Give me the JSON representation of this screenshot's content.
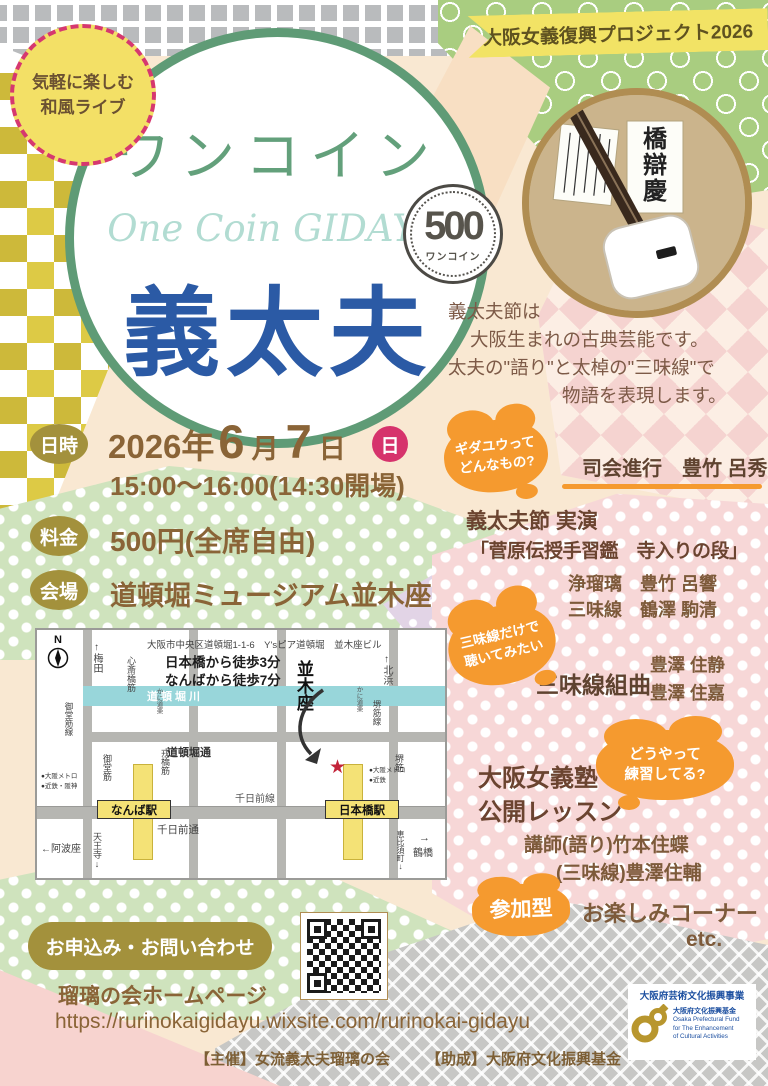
{
  "banner": {
    "text": "大阪女義復興プロジェクト2026"
  },
  "badge": {
    "line1": "気軽に楽しむ",
    "line2": "和風ライブ"
  },
  "title": {
    "katakana": "ワンコイン",
    "english": "One Coin GIDAYU",
    "kanji": "義太夫"
  },
  "coin": {
    "value": "500",
    "label": "ワンコイン"
  },
  "intro": {
    "line1": "義太夫節は",
    "line2": "大阪生まれの古典芸能です。",
    "line3": "太夫の\"語り\"と太棹の\"三味線\"で",
    "line4": "物語を表現します。"
  },
  "info": {
    "datetime_label": "日時",
    "year": "2026年",
    "month": "6",
    "month_unit": "月",
    "day": "7",
    "day_unit": "日",
    "weekday": "日",
    "time": "15:00〜16:00(14:30開場)",
    "fee_label": "料金",
    "fee": "500円(全席自由)",
    "venue_label": "会場",
    "venue": "道頓堀ミュージアム並木座"
  },
  "program": {
    "bubble1_l1": "ギダユウって",
    "bubble1_l2": "どんなもの?",
    "mc": "司会進行　豊竹 呂秀",
    "perf_title": "義太夫節 実演",
    "perf_piece": "「菅原伝授手習鑑　寺入りの段」",
    "joruri": "浄瑠璃　豊竹 呂響",
    "shamisen": "三味線　鶴澤 駒清",
    "bubble2_l1": "三味線だけで",
    "bubble2_l2": "聴いてみたい",
    "suite_title": "三味線組曲",
    "suite_name1": "豊澤 住静",
    "suite_name2": "豊澤 住嘉",
    "bubble3_l1": "どうやって",
    "bubble3_l2": "練習してる?",
    "lesson_l1": "大阪女義塾",
    "lesson_l2": "公開レッスン",
    "teacher1": "講師(語り)竹本住蝶",
    "teacher2": "(三味線)豊澤住輔",
    "participation": "参加型",
    "fun": "お楽しみコーナー",
    "etc": "etc."
  },
  "map": {
    "address": "大阪市中央区道頓堀1-1-6　Y'sピア道頓堀　並木座ビル",
    "walk1": "日本橋から徒歩3分",
    "walk2": "なんばから徒歩7分",
    "compass": "N",
    "umeda": "↑梅田",
    "kitahama": "↑北浜",
    "midosuji_line": "御堂筋線",
    "shinsaibashi": "心斎橋筋",
    "midosuji": "御堂筋",
    "ebisubashi": "戎橋筋",
    "sakaisuji_line": "堺筋線",
    "sakaisuji": "堺筋",
    "kani_west": "かに道楽",
    "kani_east": "かに道楽",
    "river": "道頓堀川",
    "dotonbori_dori": "道頓堀通",
    "sennichimae_line": "千日前線",
    "sennichimae_dori": "千日前通",
    "namba": "なんば駅",
    "namba_note1": "●大阪メトロ",
    "namba_note2": "●近鉄・阪神",
    "nihonbashi": "日本橋駅",
    "nihonbashi_note1": "●大阪メトロ",
    "nihonbashi_note2": "●近鉄",
    "awaza": "←阿波座",
    "tennoji": "天王寺↓",
    "tsuruhashi_arrow": "→",
    "tsuruhashi": "鶴橋",
    "ebisucho": "恵比須町↓",
    "namikiza": "並木座",
    "star": "★"
  },
  "contact": {
    "heading": "お申込み・お問い合わせ",
    "homepage": "瑠璃の会ホームページ",
    "url": "https://rurinokaigidayu.wixsite.com/rurinokai-gidayu"
  },
  "footer": {
    "organizer": "【主催】女流義太夫瑠璃の会",
    "grant": "【助成】大阪府文化振興基金",
    "logo_title": "大阪府芸術文化振興事業",
    "logo_jp": "大阪府文化振興基金",
    "logo_en1": "Osaka Prefectural Fund",
    "logo_en2": "for The Enhancement",
    "logo_en3": "of Cultural Activities"
  },
  "palette": {
    "accent_orange": "#f59a2f",
    "badge_olive": "#a3913c",
    "title_green": "#5f9b76",
    "title_blue": "#2b5aa5",
    "weekday_pink": "#d6336c"
  }
}
